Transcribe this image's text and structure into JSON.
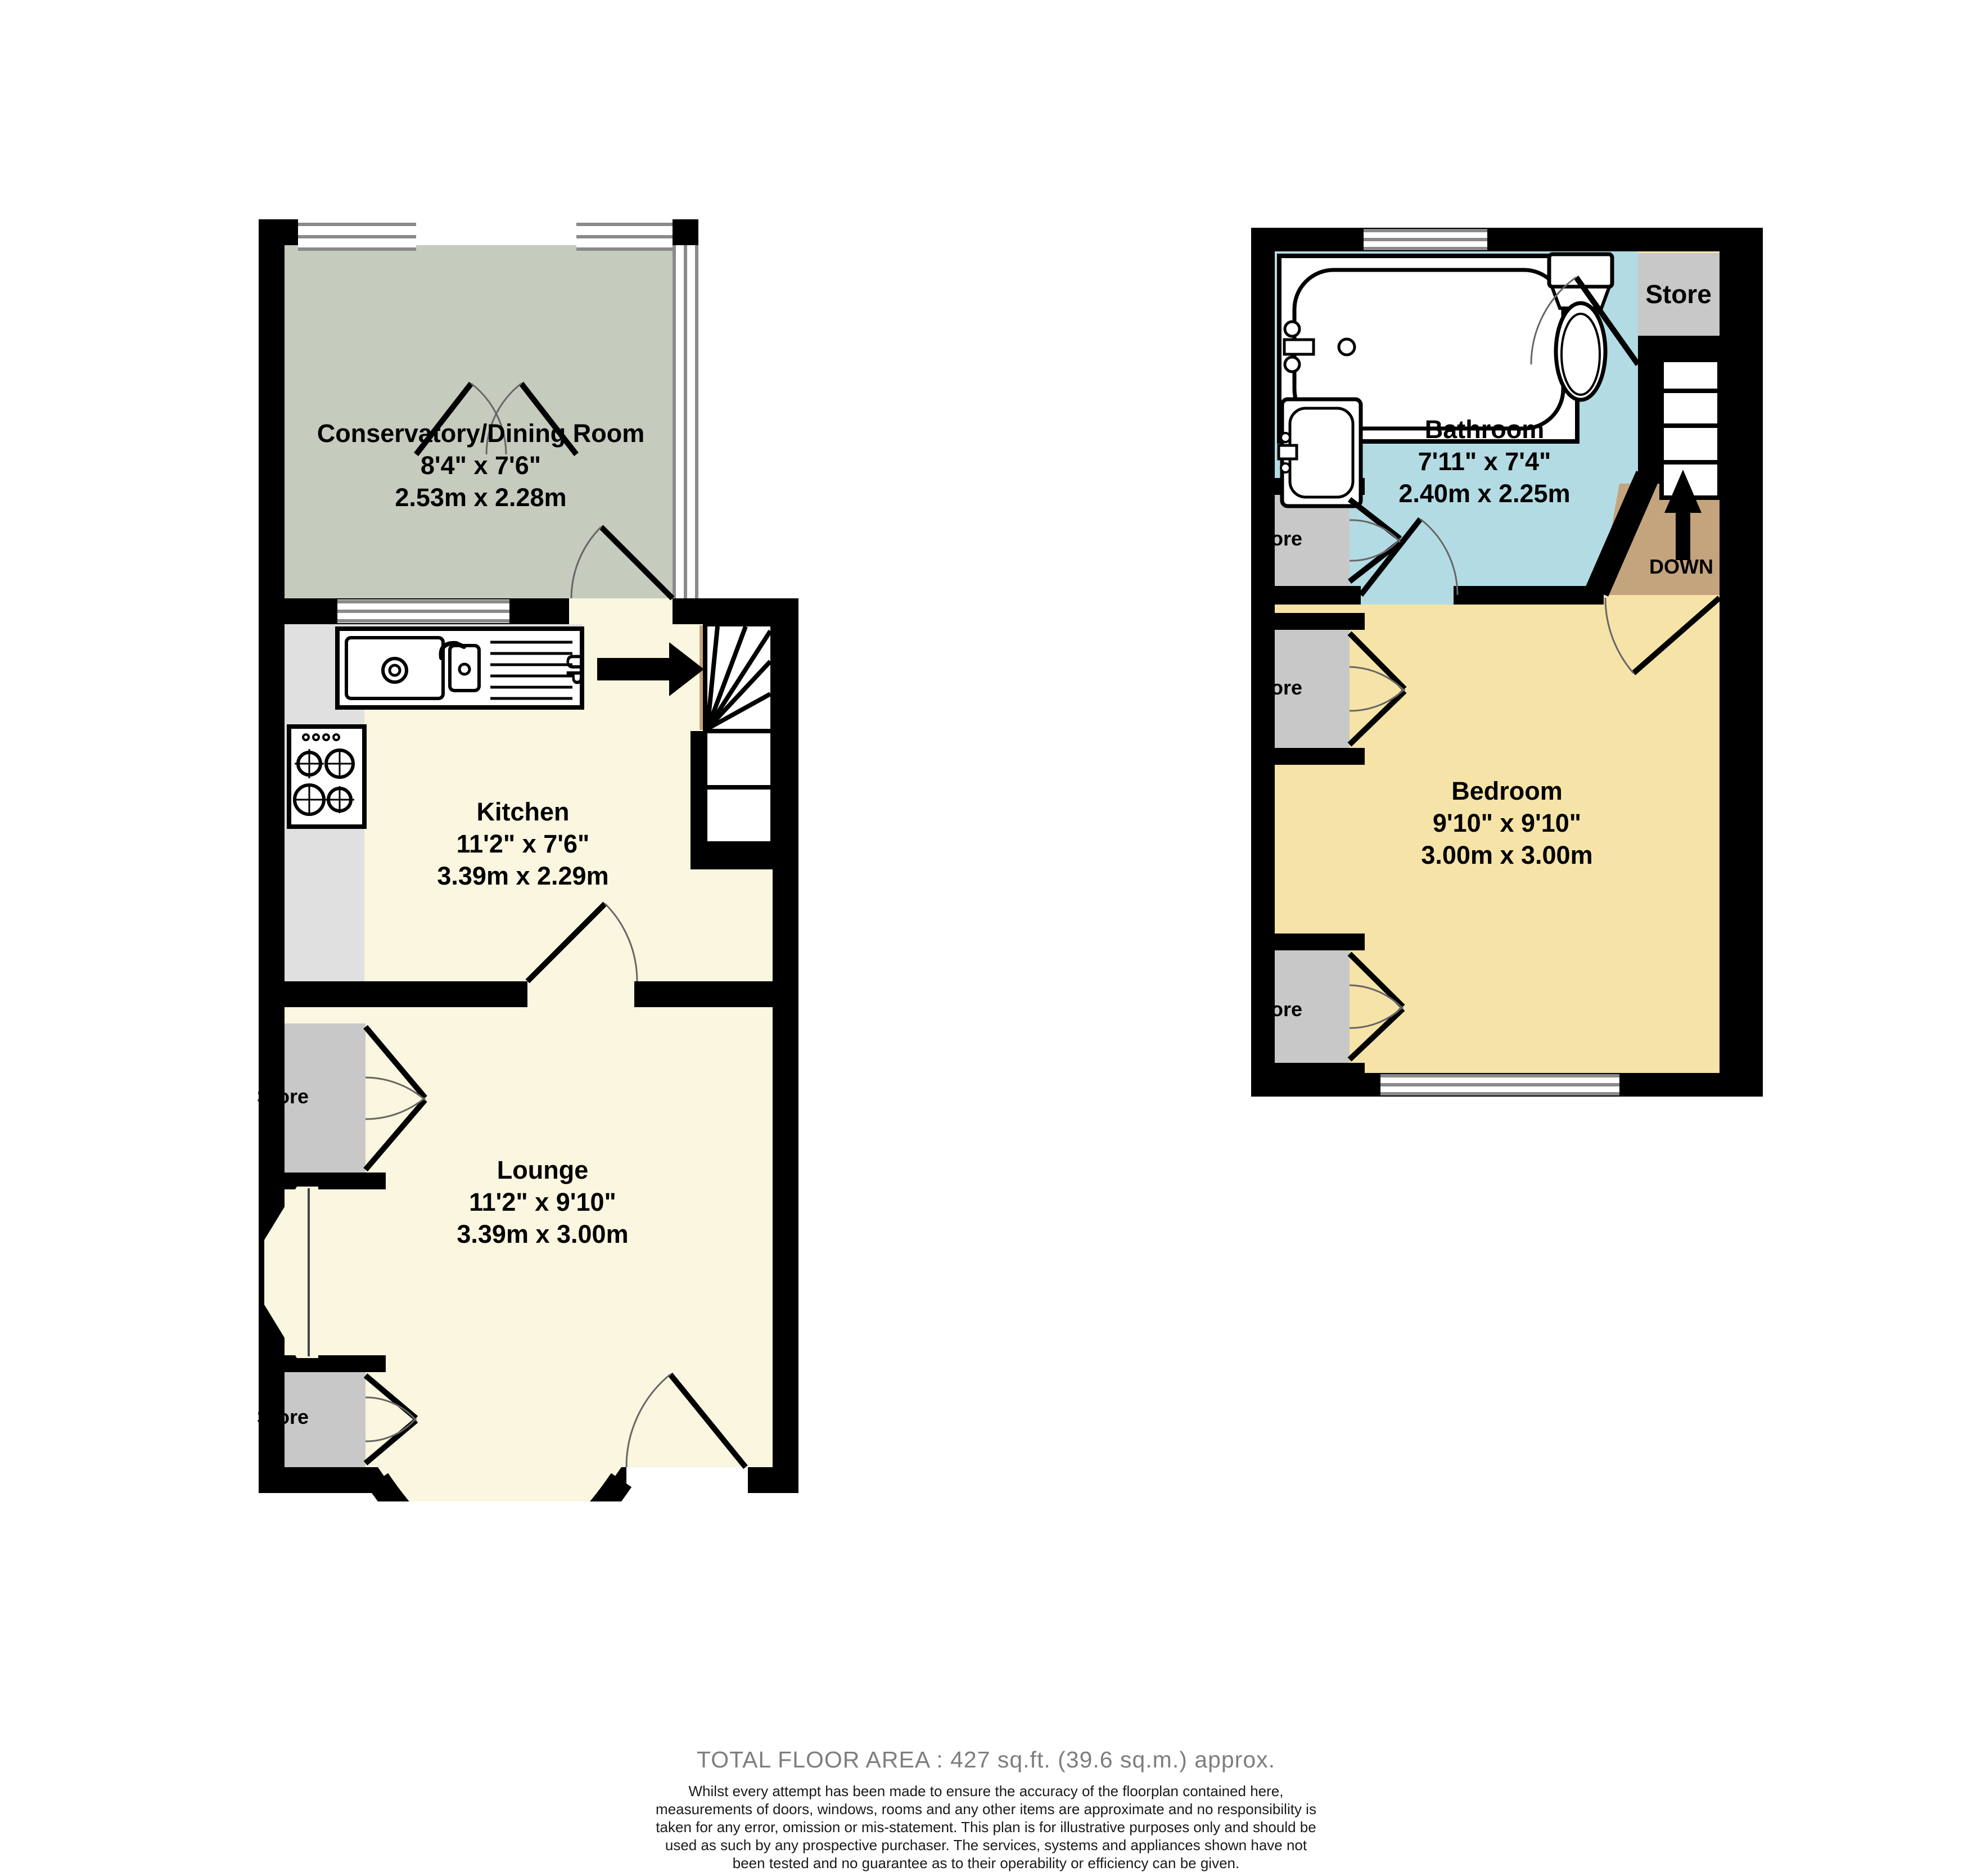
{
  "colors": {
    "wall": "#000000",
    "conservatory_floor": "#c5cbbd",
    "cream_floor": "#faf6df",
    "counter_grey": "#e0e0e0",
    "store_grey": "#c8c8c8",
    "bathroom_blue": "#b3dbe4",
    "bedroom_yellow": "#f6e3a8",
    "landing_tan": "#c4a47d",
    "window_frame": "#8a8a8a",
    "door_arc": "#666666",
    "footer_title_grey": "#7e7e7e"
  },
  "ground_floor": {
    "conservatory": {
      "name": "Conservatory/Dining Room",
      "imperial": "8'4\"  x 7'6\"",
      "metric": "2.53m  x 2.28m"
    },
    "kitchen": {
      "name": "Kitchen",
      "imperial": "11'2\"  x 7'6\"",
      "metric": "3.39m  x 2.29m"
    },
    "lounge": {
      "name": "Lounge",
      "imperial": "11'2\"  x 9'10\"",
      "metric": "3.39m  x 3.00m"
    },
    "stores": [
      "Store",
      "Store"
    ],
    "stairs_label": "UP"
  },
  "first_floor": {
    "bathroom": {
      "name": "Bathroom",
      "imperial": "7'11\"  x 7'4\"",
      "metric": "2.40m  x 2.25m"
    },
    "bedroom": {
      "name": "Bedroom",
      "imperial": "9'10\"  x 9'10\"",
      "metric": "3.00m  x 3.00m"
    },
    "store_large": "Store",
    "stores": [
      "Store",
      "Store",
      "Store"
    ],
    "stairs_label": "DOWN"
  },
  "footer": {
    "total_area": "TOTAL FLOOR AREA : 427 sq.ft. (39.6 sq.m.) approx.",
    "disclaimer": "Whilst every attempt has been made to ensure the accuracy of the floorplan contained here, measurements of doors, windows, rooms and any other items are approximate and no responsibility is taken for any error, omission or mis-statement. This plan is for illustrative purposes only and should be used as such by any prospective purchaser. The services, systems and appliances shown have not been tested and no guarantee as to their operability or efficiency can be given.",
    "credit": "Made with Metropix ©2025"
  }
}
